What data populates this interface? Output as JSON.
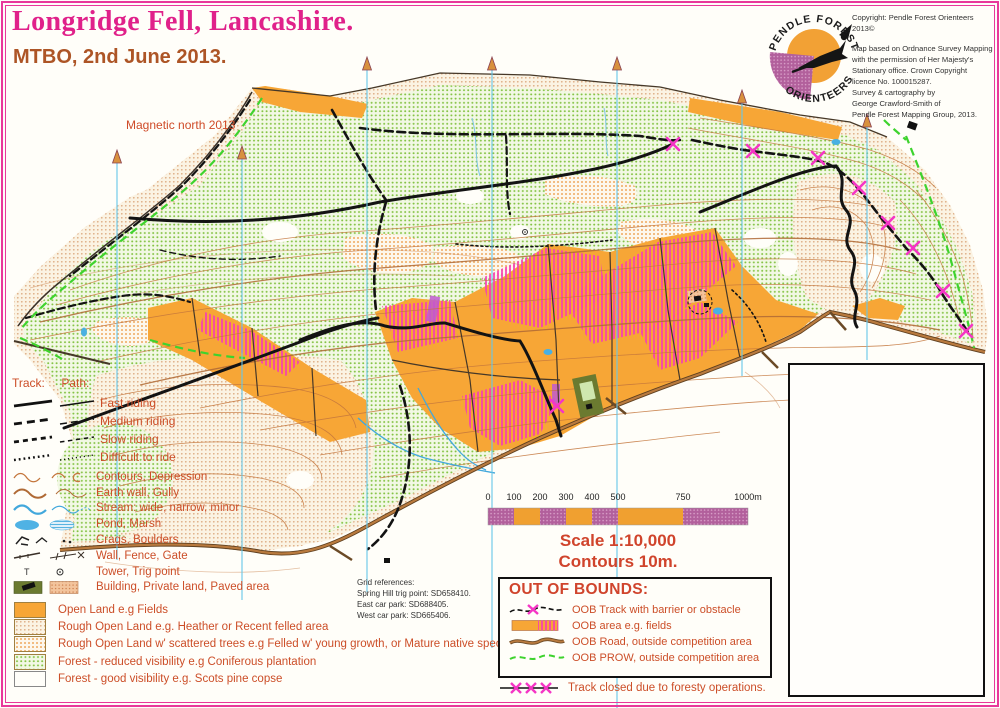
{
  "page": {
    "title": "Longridge Fell, Lancashire.",
    "subtitle": "MTBO, 2nd June 2013.",
    "magnetic_north_label": "Magnetic north 2013"
  },
  "logo": {
    "arc_top": "PENDLE FOREST",
    "arc_bottom": "ORIENTEERS"
  },
  "copyright": {
    "line1": "Copyright: Pendle Forest Orienteers 2013©",
    "lines": [
      "Map based on Ordnance Survey Mapping",
      "with the permission of Her Majesty's",
      "Stationary office.  Crown Copyright",
      "licence No. 100015287.",
      "Survey & cartography by",
      "George Crawford-Smith of",
      "Pendle Forest Mapping Group, 2013."
    ]
  },
  "legend_tracks": {
    "track_header": "Track:",
    "path_header": "Path:",
    "items": [
      "Fast riding",
      "Medium riding",
      "Slow riding",
      "Difficult to ride"
    ]
  },
  "legend_symbols": {
    "tower_glyph": "T",
    "items": [
      "Contours,  Depression",
      "Earth wall,  Gully",
      "Stream: wide, narrow, minor",
      "Pond,  Marsh",
      "Crags,  Boulders",
      "Wall,  Fence,  Gate",
      "Tower,  Trig point",
      "Building,  Private land,  Paved area"
    ]
  },
  "legend_areas": {
    "items": [
      "Open Land e.g Fields",
      "Rough Open Land  e.g. Heather or Recent felled area",
      "Rough Open Land w' scattered trees e.g Felled w' young growth, or Mature native species",
      "Forest - reduced visibility e.g Coniferous plantation",
      "Forest - good visibility e.g. Scots pine copse"
    ]
  },
  "grid_refs": {
    "header": "Grid references:",
    "lines": [
      "Spring Hill trig point: SD658410.",
      "East car park: SD688405.",
      "West car park: SD665406."
    ]
  },
  "scale": {
    "ticks": [
      "0",
      "100",
      "200",
      "300",
      "400",
      "500",
      "750",
      "1000m"
    ],
    "scale_text": "Scale 1:10,000",
    "contours_text": "Contours 10m."
  },
  "oob": {
    "title": "OUT OF BOUNDS:",
    "items": [
      "OOB Track with barrier or obstacle",
      "OOB area e.g. fields",
      "OOB Road, outside competition area",
      "OOB PROW, outside competition area"
    ],
    "track_closed": "Track closed due to foresty operations."
  },
  "colors": {
    "border_magenta": "#e8399b",
    "title_magenta": "#e0218a",
    "subtitle_brown": "#ad5526",
    "legend_text_orange": "#cc4e28",
    "scale_text_red": "#d0442c",
    "field_orange": "#f7a636",
    "oob_stripe_magenta": "#f63fb4",
    "prow_green": "#3ed32e",
    "north_line_cyan": "#66c6e8",
    "contour_brown": "#c4763c",
    "stream_blue": "#42a8dc",
    "x_mark_magenta": "#f535c5"
  }
}
